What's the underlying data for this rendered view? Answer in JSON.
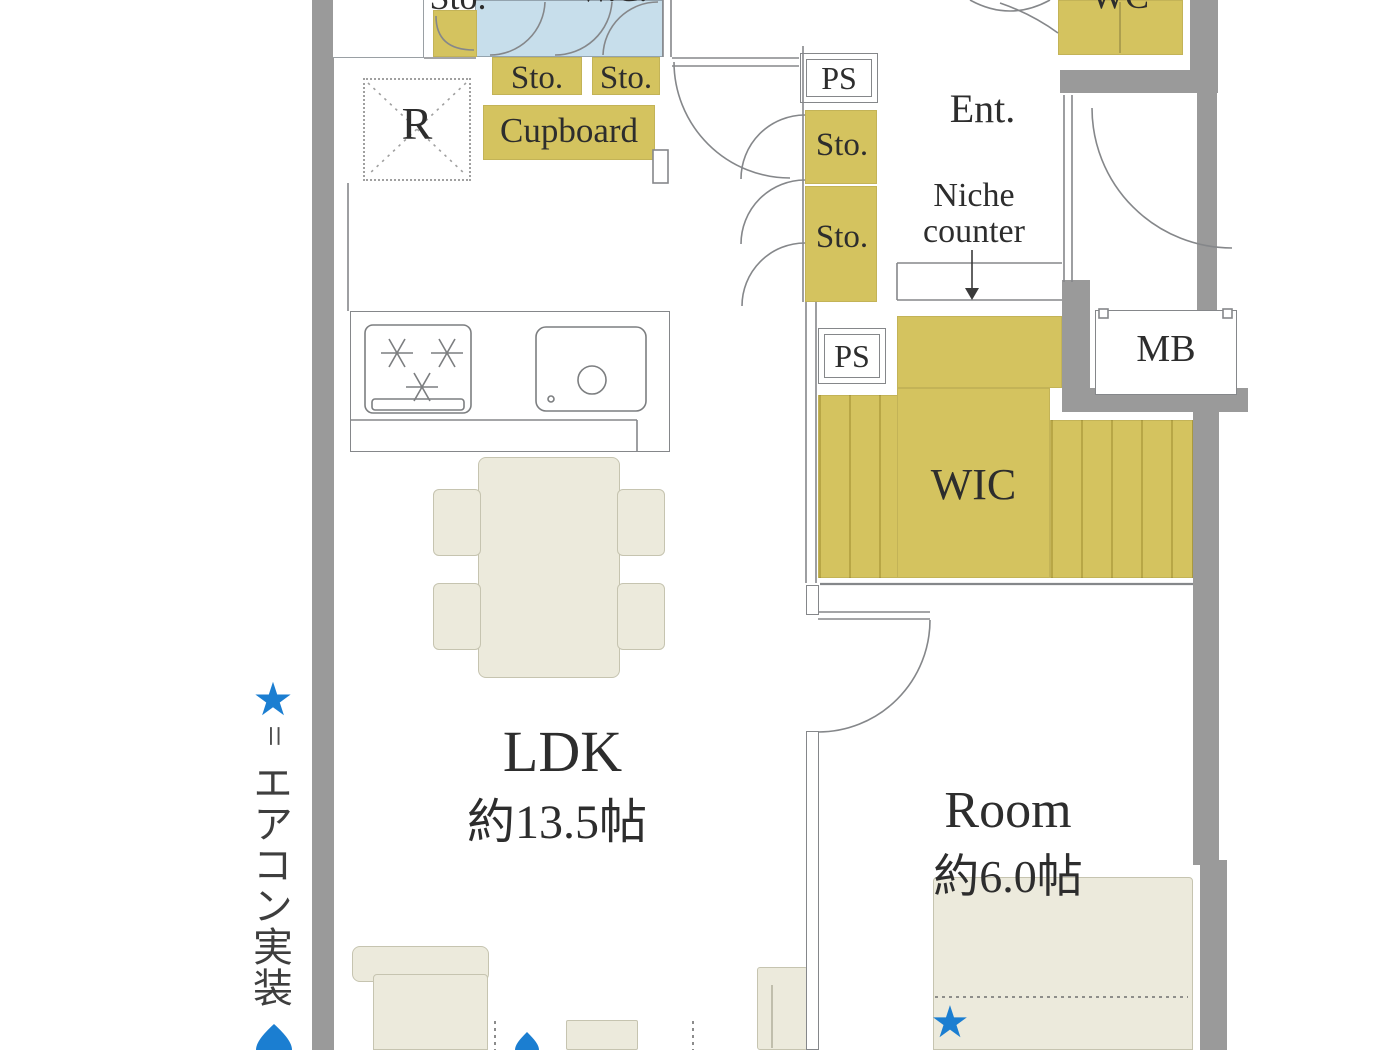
{
  "plan": {
    "kitchen": {
      "refrigerator_label": "R",
      "cupboard_label": "Cupboard",
      "storage_top_label": "Sto.",
      "storage_label_1": "Sto.",
      "storage_label_2": "Sto."
    },
    "hallway": {
      "pipe_shaft_top": "PS",
      "storage_label_1": "Sto.",
      "storage_label_2": "Sto.",
      "pipe_shaft_mid": "PS"
    },
    "entrance": {
      "label": "Ent.",
      "niche_counter_line1": "Niche",
      "niche_counter_line2": "counter",
      "wc_label": "WC"
    },
    "washroom": {
      "partial_label": "W.C."
    },
    "walk_in_closet": {
      "label": "WIC"
    },
    "meter_box": {
      "label": "MB"
    },
    "ldk": {
      "name": "LDK",
      "area": "約13.5帖"
    },
    "bedroom": {
      "name": "Room",
      "area": "約6.0帖",
      "aircon_star": "★"
    }
  },
  "legend": {
    "star": "★",
    "equals": "=",
    "text": "エアコン実装"
  },
  "colors": {
    "wall_gray": "#9a9a9a",
    "storage_olive": "#d4c35f",
    "washroom_blue": "#c7deeb",
    "furniture_cream": "#eceadc",
    "accent_blue": "#1b7ed1",
    "line_gray": "#85878a",
    "text_dark": "#2d2d2d"
  }
}
